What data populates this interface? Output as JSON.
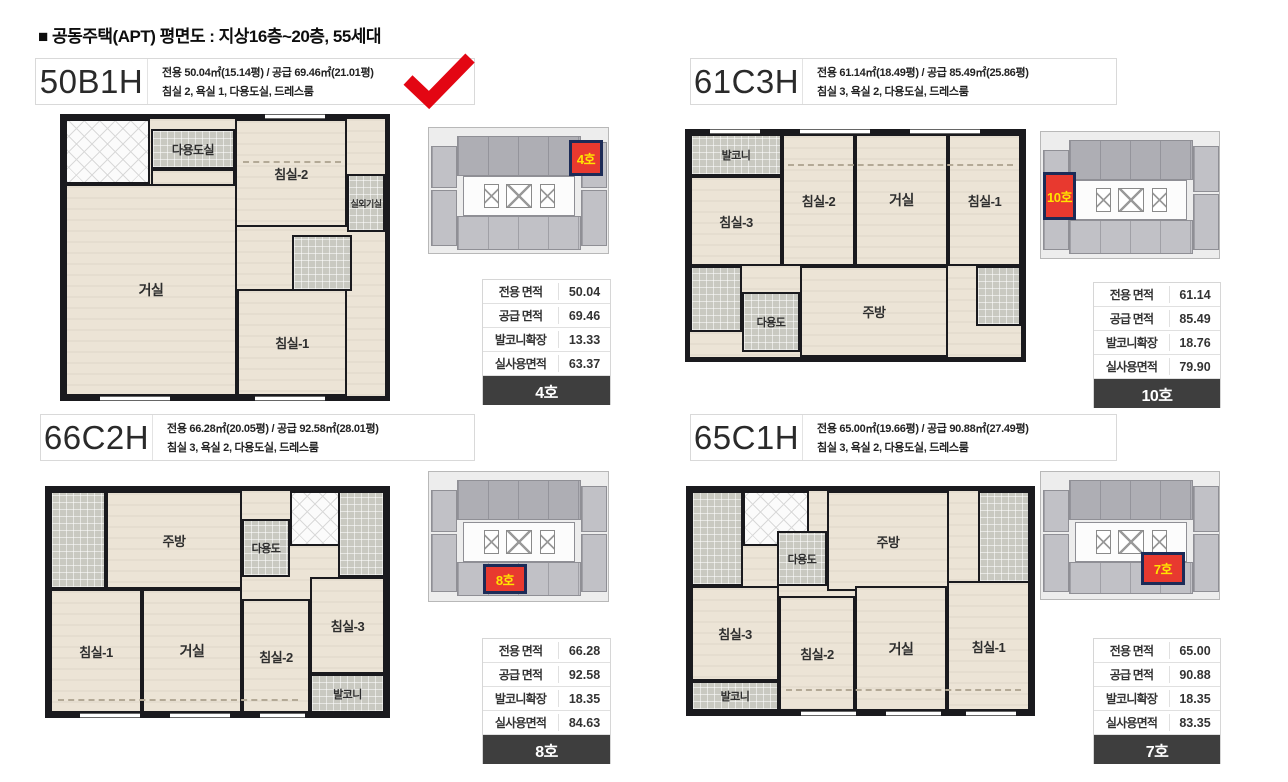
{
  "page_title": "■ 공동주택(APT)  평면도 : 지상16층~20층, 55세대",
  "colors": {
    "accent_red": "#e8392f",
    "check_red": "#e30613",
    "highlight_text_yellow": "#ffe400",
    "highlight_border_navy": "#1c2b57",
    "table_footer_dark": "#3e3e3e",
    "floor_cream": "#ece4d6",
    "tile_gray": "#c9c9c1",
    "wall_black": "#1a1a1e",
    "keyplan_gray": "#c1c1c6"
  },
  "units": [
    {
      "name": "50B1H",
      "spec1": "전용 50.04㎡(15.14평) / 공급 69.46㎡(21.01평)",
      "spec2": "침실 2, 욕실 1, 다용도실, 드레스룸",
      "checked": true,
      "keyplan_unit": "4호",
      "rooms": [
        {
          "name": "utility",
          "label": "다용도실"
        },
        {
          "name": "kitchen",
          "label": "주방"
        },
        {
          "name": "bedroom-2",
          "label": "침실-2"
        },
        {
          "name": "outdoor-unit-room",
          "label": "실외기실"
        },
        {
          "name": "living-room",
          "label": "거실"
        },
        {
          "name": "bedroom-1",
          "label": "침실-1"
        }
      ],
      "table": {
        "rows": [
          {
            "label": "전용 면적",
            "value": "50.04"
          },
          {
            "label": "공급 면적",
            "value": "69.46"
          },
          {
            "label": "발코니확장",
            "value": "13.33"
          },
          {
            "label": "실사용면적",
            "value": "63.37"
          }
        ],
        "unit_no": "4호"
      }
    },
    {
      "name": "61C3H",
      "spec1": "전용 61.14㎡(18.49평) / 공급 85.49㎡(25.86평)",
      "spec2": "침실 3, 욕실 2, 다용도실, 드레스룸",
      "checked": false,
      "keyplan_unit": "10호",
      "rooms": [
        {
          "name": "balcony",
          "label": "발코니"
        },
        {
          "name": "bedroom-3",
          "label": "침실-3"
        },
        {
          "name": "bedroom-2",
          "label": "침실-2"
        },
        {
          "name": "living-room",
          "label": "거실"
        },
        {
          "name": "bedroom-1",
          "label": "침실-1"
        },
        {
          "name": "utility",
          "label": "다용도"
        },
        {
          "name": "kitchen",
          "label": "주방"
        }
      ],
      "table": {
        "rows": [
          {
            "label": "전용 면적",
            "value": "61.14"
          },
          {
            "label": "공급 면적",
            "value": "85.49"
          },
          {
            "label": "발코니확장",
            "value": "18.76"
          },
          {
            "label": "실사용면적",
            "value": "79.90"
          }
        ],
        "unit_no": "10호"
      }
    },
    {
      "name": "66C2H",
      "spec1": "전용 66.28㎡(20.05평) / 공급 92.58㎡(28.01평)",
      "spec2": "침실 3, 욕실 2, 다용도실, 드레스룸",
      "checked": false,
      "keyplan_unit": "8호",
      "rooms": [
        {
          "name": "kitchen",
          "label": "주방"
        },
        {
          "name": "utility",
          "label": "다용도"
        },
        {
          "name": "bedroom-1",
          "label": "침실-1"
        },
        {
          "name": "living-room",
          "label": "거실"
        },
        {
          "name": "bedroom-2",
          "label": "침실-2"
        },
        {
          "name": "bedroom-3",
          "label": "침실-3"
        },
        {
          "name": "balcony",
          "label": "발코니"
        }
      ],
      "table": {
        "rows": [
          {
            "label": "전용 면적",
            "value": "66.28"
          },
          {
            "label": "공급 면적",
            "value": "92.58"
          },
          {
            "label": "발코니확장",
            "value": "18.35"
          },
          {
            "label": "실사용면적",
            "value": "84.63"
          }
        ],
        "unit_no": "8호"
      }
    },
    {
      "name": "65C1H",
      "spec1": "전용 65.00㎡(19.66평) / 공급 90.88㎡(27.49평)",
      "spec2": "침실 3, 욕실 2, 다용도실, 드레스룸",
      "checked": false,
      "keyplan_unit": "7호",
      "rooms": [
        {
          "name": "utility",
          "label": "다용도"
        },
        {
          "name": "kitchen",
          "label": "주방"
        },
        {
          "name": "bedroom-3",
          "label": "침실-3"
        },
        {
          "name": "balcony",
          "label": "발코니"
        },
        {
          "name": "bedroom-2",
          "label": "침실-2"
        },
        {
          "name": "living-room",
          "label": "거실"
        },
        {
          "name": "bedroom-1",
          "label": "침실-1"
        }
      ],
      "table": {
        "rows": [
          {
            "label": "전용 면적",
            "value": "65.00"
          },
          {
            "label": "공급 면적",
            "value": "90.88"
          },
          {
            "label": "발코니확장",
            "value": "18.35"
          },
          {
            "label": "실사용면적",
            "value": "83.35"
          }
        ],
        "unit_no": "7호"
      }
    }
  ]
}
